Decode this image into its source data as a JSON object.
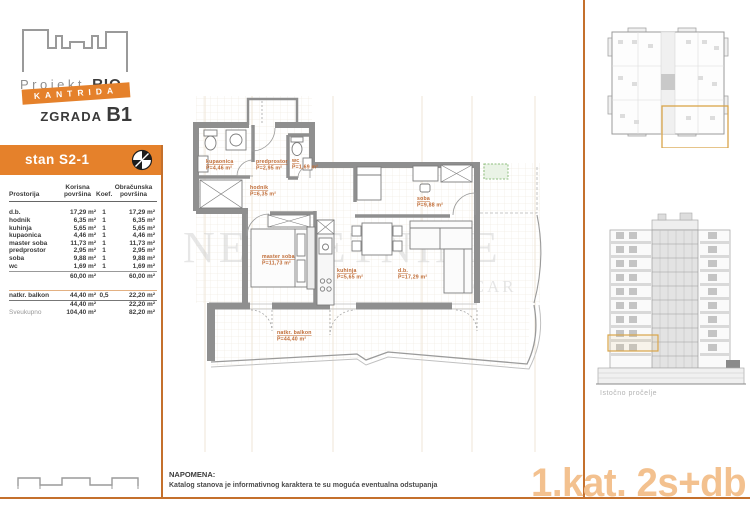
{
  "logo": {
    "project": "Projekt",
    "project_bold": "RIO",
    "banner": "KANTRIDA",
    "building": "ZGRADA",
    "building_code": "B1"
  },
  "unit": {
    "title": "stan S2-1"
  },
  "area_table": {
    "col_headers": {
      "room": "Prostorija",
      "useful": "Korisna\npovršina",
      "coef": "Koef.",
      "billable": "Obračunska\npovršina"
    },
    "rows": [
      {
        "name": "d.b.",
        "useful": "17,29 m²",
        "coef": "1",
        "billable": "17,29 m²"
      },
      {
        "name": "hodnik",
        "useful": "6,35 m²",
        "coef": "1",
        "billable": "6,35 m²"
      },
      {
        "name": "kuhinja",
        "useful": "5,65 m²",
        "coef": "1",
        "billable": "5,65 m²"
      },
      {
        "name": "kupaonica",
        "useful": "4,46 m²",
        "coef": "1",
        "billable": "4,46 m²"
      },
      {
        "name": "master soba",
        "useful": "11,73 m²",
        "coef": "1",
        "billable": "11,73 m²"
      },
      {
        "name": "predprostor",
        "useful": "2,95 m²",
        "coef": "1",
        "billable": "2,95 m²"
      },
      {
        "name": "soba",
        "useful": "9,88 m²",
        "coef": "1",
        "billable": "9,88 m²"
      },
      {
        "name": "wc",
        "useful": "1,69 m²",
        "coef": "1",
        "billable": "1,69 m²"
      }
    ],
    "subtotal_interior": {
      "useful": "60,00 m²",
      "billable": "60,00 m²"
    },
    "balcony_row": {
      "name": "natkr. balkon",
      "useful": "44,40 m²",
      "coef": "0,5",
      "billable": "22,20 m²"
    },
    "subtotal_balcony": {
      "useful": "44,40 m²",
      "billable": "22,20 m²"
    },
    "total": {
      "name": "Sveukupno",
      "useful": "104,40 m²",
      "billable": "82,20 m²"
    }
  },
  "plan": {
    "watermark": "NEKRETNINE",
    "watermark_fragment": "Z CAR",
    "rooms": [
      {
        "name": "kupaonica",
        "area": "P=4,46 m²"
      },
      {
        "name": "predprostor",
        "area": "P=2,95 m²"
      },
      {
        "name": "wc",
        "area": "P=1,69 m²"
      },
      {
        "name": "hodnik",
        "area": "P=6,35 m²"
      },
      {
        "name": "master soba",
        "area": "P=11,73 m²"
      },
      {
        "name": "kuhinja",
        "area": "P=5,65 m²"
      },
      {
        "name": "soba",
        "area": "P=9,88 m²"
      },
      {
        "name": "d.b.",
        "area": "P=17,29 m²"
      },
      {
        "name": "natkr. balkon",
        "area": "P=44,40 m²"
      }
    ]
  },
  "sidebar": {
    "elevation_caption": "Istočno pročelje"
  },
  "footer": {
    "note_title": "NAPOMENA:",
    "note_body": "Katalog stanova je informativnog karaktera te su moguća eventualna odstupanja",
    "unit_tag": "1.kat. 2s+db"
  },
  "colors": {
    "accent_orange": "#E5812B",
    "divider_orange": "#C4702C",
    "room_label_orange": "#BF6A34",
    "highlight_yellow": "#D9A54A",
    "unit_tag_orange": "#F3C18F",
    "wall_gray": "#8F8F8F"
  }
}
